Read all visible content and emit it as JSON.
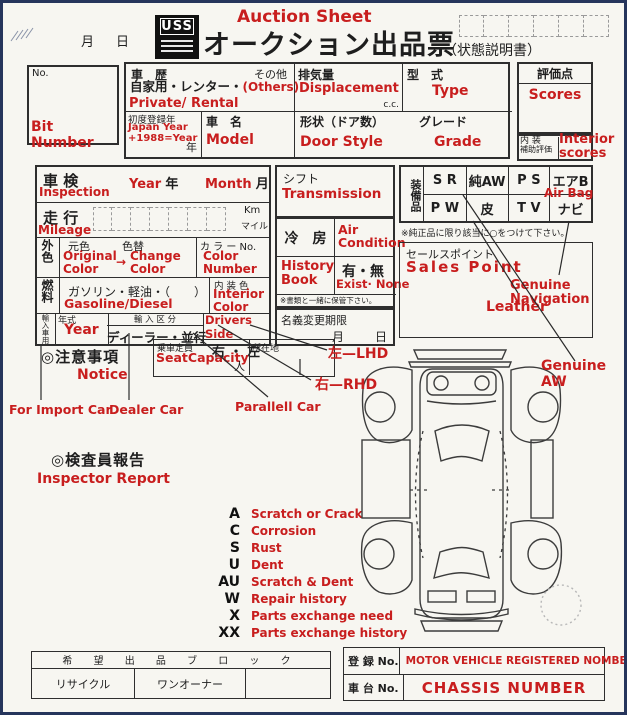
{
  "colors": {
    "red": "#c81e1e",
    "ink": "#1e1e1e",
    "frame": "#26355c",
    "paper": "#f7f6f1"
  },
  "header": {
    "month": "月",
    "day": "日",
    "logo": "USS",
    "auction_sheet": "Auction Sheet",
    "title": "オークション出品票",
    "subtitle": "（状態説明書）"
  },
  "bit": {
    "no": "No.",
    "en": "Bit Number"
  },
  "vehicle": {
    "history_jp": "車　歴",
    "other": "その他",
    "opts_black": "自家用・レンター・",
    "opts_red": "(Others)",
    "history_en": "Private/ Rental",
    "disp_jp": "排気量",
    "disp_en": "Displacement",
    "cc": "c.c.",
    "type_jp": "型　式",
    "type_en": "Type",
    "firstreg_jp": "初度登録年",
    "firstreg_en1": "Japan Year",
    "firstreg_en2": "+1988=Year",
    "year_suffix": "年",
    "model_jp": "車　名",
    "model_en": "Model",
    "door_jp": "形状（ドア数）",
    "door_en": "Door Style",
    "grade_jp": "グレード",
    "grade_en": "Grade"
  },
  "scores": {
    "jp": "評価点",
    "en": "Scores",
    "int_jp1": "内 装",
    "int_jp2": "補助評価",
    "int_en": "Interior scores"
  },
  "insp": {
    "jp": "車 検",
    "en": "Inspection",
    "year_en": "Year",
    "year_jp": "年",
    "month_en": "Month",
    "month_jp": "月"
  },
  "mile": {
    "jp": "走 行",
    "en": "Mileage",
    "km": "Km",
    "mile": "マイル"
  },
  "color": {
    "label": "外色",
    "orig_jp": "元色",
    "change_jp": "色替",
    "orig_en": "Original Color",
    "arrow": "→",
    "change_en": "Change Color",
    "no_jp": "カ ラ ー No.",
    "no_en": "Color Number"
  },
  "fuel": {
    "label": "燃料",
    "opts": "ガソリン・軽油・（　　）",
    "en": "Gasoline/Diesel",
    "int_jp": "内 装 色",
    "int_en": "Interior Color"
  },
  "import_row": {
    "label": "輸入車用",
    "year_jp": "年式",
    "year_en": "Year",
    "class_jp": "輸 入 区 分",
    "class_opts": "ディーラー・並行",
    "drivers_en": "Drivers Side",
    "drivers_opts": "右 ・ 左"
  },
  "middle": {
    "shift_jp": "シフト",
    "shift_en": "Transmission",
    "ac_jp": "冷　房",
    "ac_en": "Air Condition",
    "hb_en": "History Book",
    "exist_jp": "有・無",
    "exist_en": "Exist· None",
    "keep": "※書類と一緒に保管下さい。",
    "nc_jp": "名義変更期限",
    "nc_m": "月",
    "nc_d": "日"
  },
  "equip": {
    "label": "装備品",
    "cells": [
      "S R",
      "純AW",
      "P S",
      "エアB",
      "P W",
      "皮",
      "T V",
      "ナビ"
    ],
    "airbag": "Air Bag",
    "note": "※純正品に限り該当に○をつけて下さい。"
  },
  "sales": {
    "jp": "セールスポイント",
    "en": "Sales Point",
    "leather": "Leather",
    "nav": "Genuine Navigation",
    "aw": "Genuine AW"
  },
  "ann": {
    "lhd": "左—LHD",
    "rhd": "右—RHD",
    "imp": "For Import Car",
    "dealer": "Dealer Car",
    "parallel": "Parallell Car"
  },
  "notice": {
    "jp": "◎注意事項",
    "en": "Notice"
  },
  "seat": {
    "jp": "乗車定員",
    "en": "SeatCapacity",
    "unit": "人",
    "loc": "所在地"
  },
  "inspector": {
    "jp": "◎検査員報告",
    "en": "Inspector Report"
  },
  "legend": {
    "items": [
      {
        "code": "A",
        "desc": "Scratch or Crack"
      },
      {
        "code": "C",
        "desc": "Corrosion"
      },
      {
        "code": "S",
        "desc": "Rust"
      },
      {
        "code": "U",
        "desc": "Dent"
      },
      {
        "code": "AU",
        "desc": "Scratch & Dent"
      },
      {
        "code": "W",
        "desc": "Repair history"
      },
      {
        "code": "X",
        "desc": "Parts exchange need"
      },
      {
        "code": "XX",
        "desc": "Parts exchange history"
      }
    ]
  },
  "bottom": {
    "block_header": "希 望 出 品 ブ ロ ッ ク",
    "cell1": "リサイクル",
    "cell2": "ワンオーナー",
    "reg_label": "登 録 No.",
    "reg_value": "MOTOR VEHICLE  REGISTERED NOMBER",
    "ch_label": "車 台 No.",
    "ch_value": "CHASSIS NUMBER"
  }
}
